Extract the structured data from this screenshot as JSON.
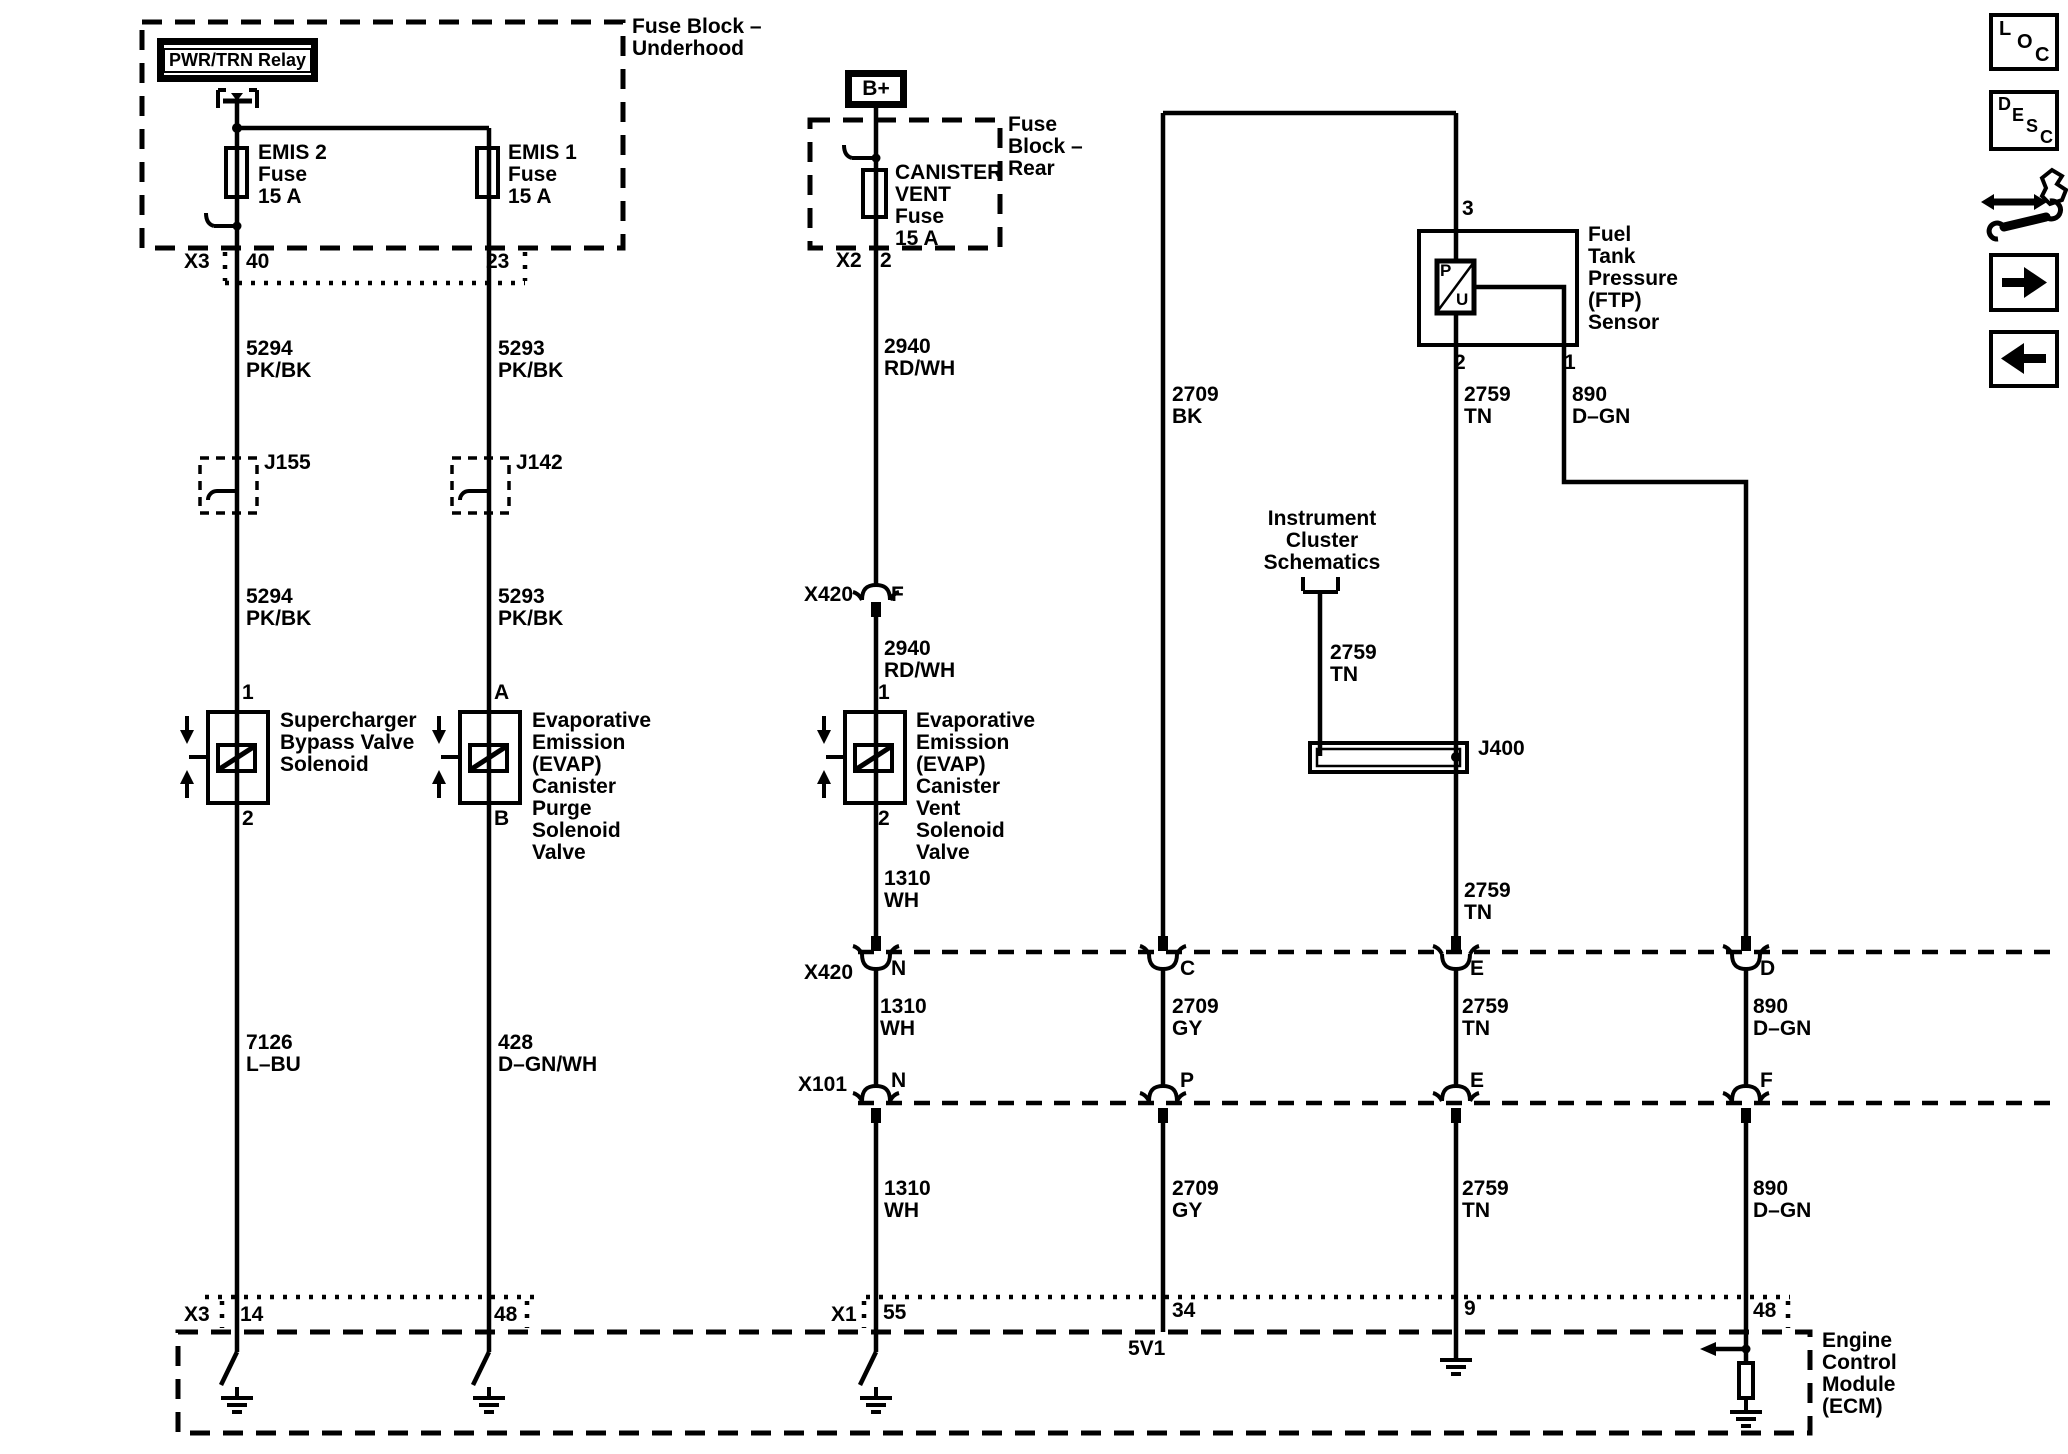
{
  "underhood": {
    "block_label": "Fuse Block –\nUnderhood",
    "relay_label": "PWR/TRN Relay",
    "fuse_emis2": "EMIS 2\nFuse\n15 A",
    "fuse_emis1": "EMIS 1\nFuse\n15 A",
    "conn": "X3",
    "pin_emis2": "40",
    "pin_emis1": "23"
  },
  "rear_block": {
    "label": "Fuse\nBlock –\nRear",
    "bplus": "B+",
    "fuse": "CANISTER\nVENT\nFuse\n15 A",
    "conn": "X2",
    "pin": "2"
  },
  "left_branch": {
    "wire_top": "5294\nPK/BK",
    "splice": "J155",
    "wire_mid": "5294\nPK/BK",
    "pin_top": "1",
    "solenoid": "Supercharger\nBypass Valve\nSolenoid",
    "pin_bot": "2",
    "wire_bot": "7126\nL–BU",
    "ecm_conn": "X3",
    "ecm_pin": "14"
  },
  "purge_branch": {
    "wire_top": "5293\nPK/BK",
    "splice": "J142",
    "wire_mid": "5293\nPK/BK",
    "pin_top": "A",
    "solenoid": "Evaporative\nEmission\n(EVAP)\nCanister\nPurge\nSolenoid\nValve",
    "pin_bot": "B",
    "wire_bot": "428\nD–GN/WH",
    "ecm_pin": "48"
  },
  "vent_branch": {
    "wire_top": "2940\nRD/WH",
    "conn_mid": "X420",
    "conn_mid_pin": "F",
    "wire_mid": "2940\nRD/WH",
    "pin_top": "1",
    "solenoid": "Evaporative\nEmission\n(EVAP)\nCanister\nVent\nSolenoid\nValve",
    "pin_bot": "2",
    "wire1": "1310\nWH",
    "x420_label": "X420",
    "x420_pin": "N",
    "wire2": "1310\nWH",
    "x101_label": "X101",
    "x101_pin": "N",
    "wire3": "1310\nWH",
    "ecm_conn": "X1",
    "ecm_pin": "55"
  },
  "ftp": {
    "label": "Fuel\nTank\nPressure\n(FTP)\nSensor",
    "sym_p": "P",
    "sym_u": "U",
    "pin3": "3",
    "pin2": "2",
    "pin1": "1"
  },
  "signal_5v": {
    "wire_top": "2709\nBK",
    "x420_pin": "C",
    "wire2": "2709\nGY",
    "x101_pin": "P",
    "wire3": "2709\nGY",
    "ecm_pin": "34",
    "ecm_net": "5V1"
  },
  "signal_tn": {
    "wire_top": "2759\nTN",
    "wire_mid": "2759\nTN",
    "x420_pin": "E",
    "wire2": "2759\nTN",
    "x101_pin": "E",
    "wire3": "2759\nTN",
    "ecm_pin": "9"
  },
  "cluster": {
    "label": "Instrument\nCluster\nSchematics",
    "wire": "2759\nTN",
    "splice": "J400"
  },
  "signal_gn": {
    "wire_top": "890\nD–GN",
    "x420_pin": "D",
    "wire2": "890\nD–GN",
    "x101_pin": "F",
    "wire3": "890\nD–GN",
    "ecm_pin": "48"
  },
  "ecm": {
    "label": "Engine\nControl\nModule\n(ECM)"
  },
  "nav": {
    "loc": [
      "L",
      "O",
      "C"
    ],
    "desc": [
      "D",
      "E",
      "S",
      "C"
    ]
  }
}
